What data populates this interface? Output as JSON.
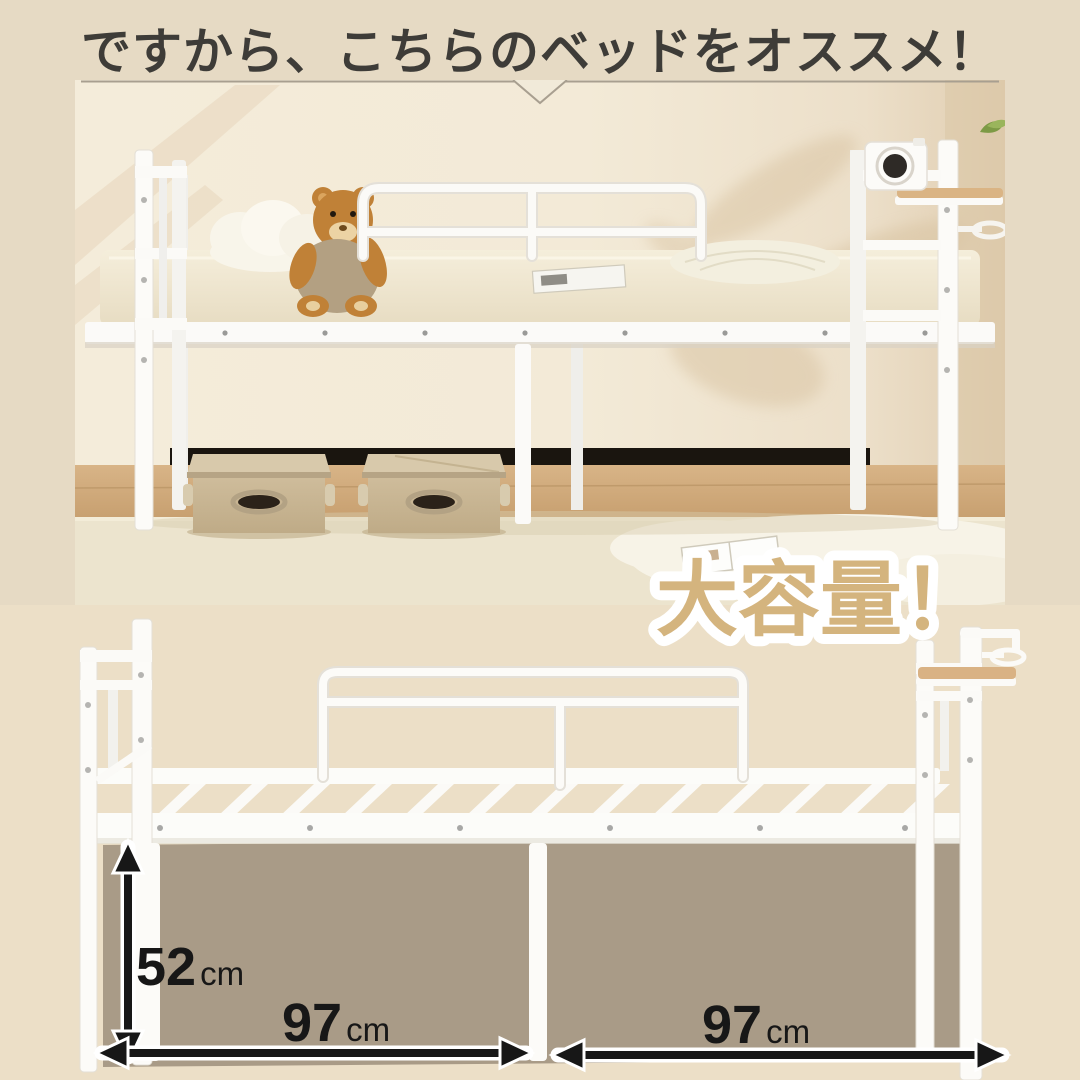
{
  "header": {
    "title": "ですから、こちらのベッドをオススメ！",
    "text_color": "#3e3c38",
    "bg_color": "#e6dac4"
  },
  "photo": {
    "items": [
      "white-steel-loft-bed",
      "headboard-left",
      "headboard-right",
      "guard-rail",
      "mattress",
      "cloud-pillow",
      "teddy-bear",
      "round-pleated-cushion",
      "magazine",
      "storage-box-left",
      "storage-box-right",
      "retro-camera",
      "wooden-shelf",
      "cup-holder-ring",
      "fluffy-rug",
      "green-leaf"
    ]
  },
  "badge": {
    "label": "大容量！",
    "fill_color": "#d4b47e",
    "outline_color": "#ffffff"
  },
  "diagram": {
    "bg_color": "#ecdfc7",
    "storage_area_color": "#a99b87",
    "arrow_color": "#171717",
    "height": {
      "value": "52",
      "unit": "cm"
    },
    "width_left": {
      "value": "97",
      "unit": "cm"
    },
    "width_right": {
      "value": "97",
      "unit": "cm"
    }
  }
}
